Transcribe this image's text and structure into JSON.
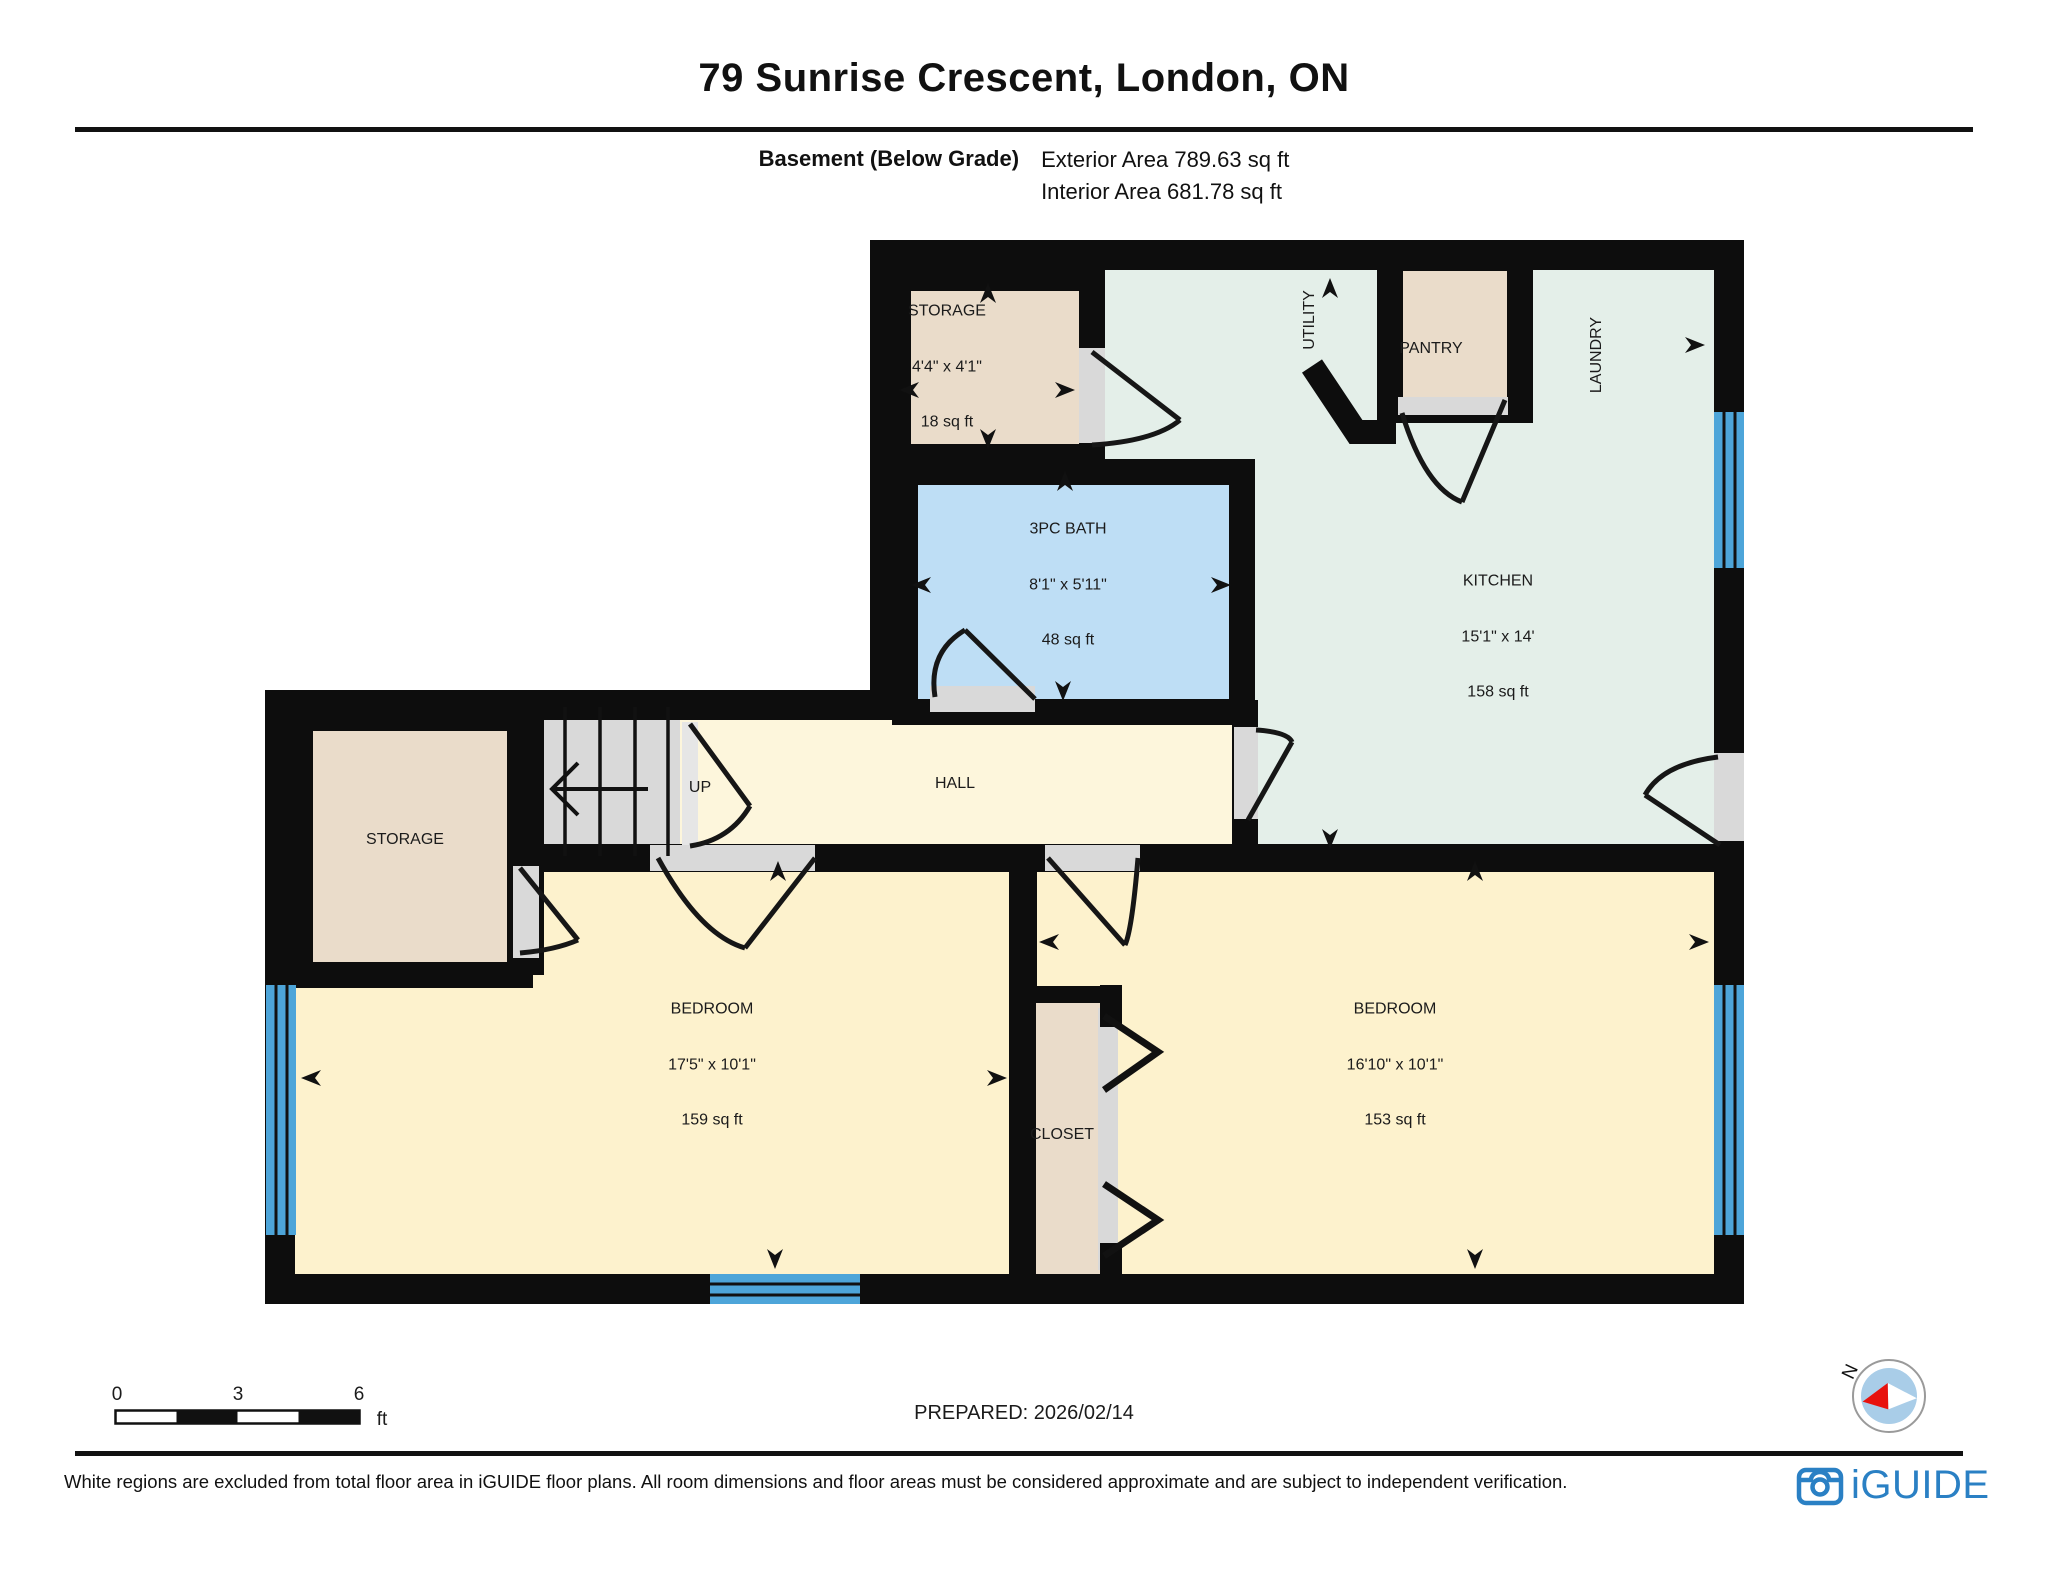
{
  "header": {
    "title": "79 Sunrise Crescent, London, ON"
  },
  "floor_info": {
    "floor_name": "Basement (Below Grade)",
    "exterior_area": "Exterior Area 789.63 sq ft",
    "interior_area": "Interior Area 681.78 sq ft"
  },
  "rooms": {
    "storage_top": {
      "name": "STORAGE",
      "dimensions": "4'4\" x 4'1\"",
      "area": "18 sq ft"
    },
    "utility": {
      "name": "UTILITY"
    },
    "pantry": {
      "name": "PANTRY"
    },
    "laundry": {
      "name": "LAUNDRY"
    },
    "bath": {
      "name": "3PC BATH",
      "dimensions": "8'1\" x 5'11\"",
      "area": "48 sq ft"
    },
    "kitchen": {
      "name": "KITCHEN",
      "dimensions": "15'1\" x 14'",
      "area": "158 sq ft"
    },
    "hall": {
      "name": "HALL"
    },
    "stairs": {
      "direction_label": "UP"
    },
    "storage_left": {
      "name": "STORAGE"
    },
    "bedroom_left": {
      "name": "BEDROOM",
      "dimensions": "17'5\" x 10'1\"",
      "area": "159 sq ft"
    },
    "closet": {
      "name": "CLOSET"
    },
    "bedroom_right": {
      "name": "BEDROOM",
      "dimensions": "16'10\" x 10'1\"",
      "area": "153 sq ft"
    }
  },
  "scale_bar": {
    "tick_0": "0",
    "tick_3": "3",
    "tick_6": "6",
    "unit": "ft"
  },
  "prepared_text": "PREPARED: 2026/02/14",
  "compass": {
    "north_label": "N"
  },
  "footer": {
    "disclaimer": "White regions are excluded from total floor area in iGUIDE floor plans. All room dimensions and floor areas must be considered approximate and are subject to independent verification.",
    "brand": "iGUIDE"
  },
  "colors": {
    "wall": "#0d0d0d",
    "storage_fill": "#eadcca",
    "kitchen_fill": "#e4efe9",
    "bath_fill": "#bedef5",
    "hall_fill": "#fdf6dc",
    "bedroom_fill": "#fdf2cd",
    "window_blue": "#4da5d9",
    "stairs_gray": "#d9d9d9",
    "brand_blue": "#2a80c4"
  }
}
